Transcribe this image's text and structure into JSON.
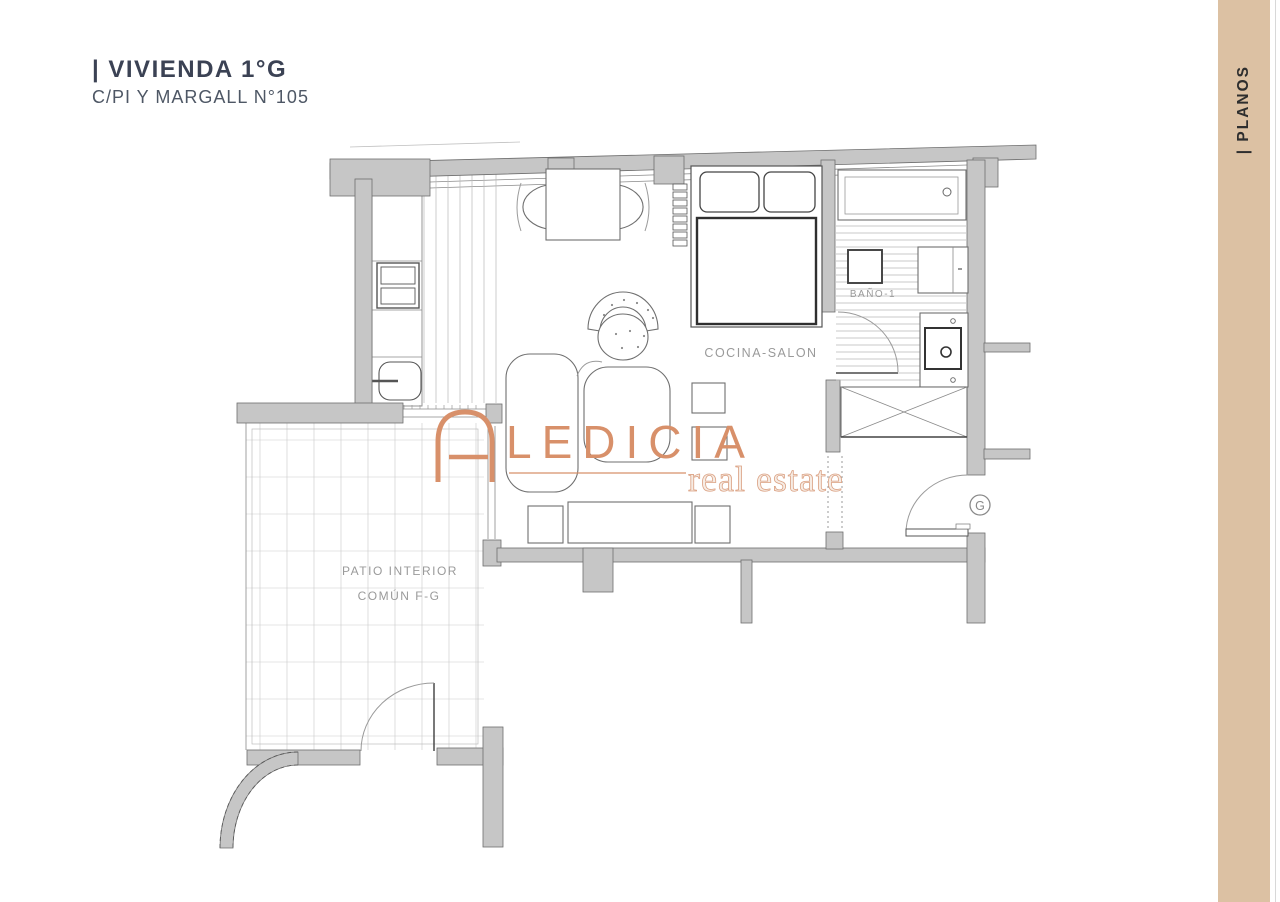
{
  "header": {
    "title": "| VIVIENDA 1°G",
    "subtitle": "C/PI Y MARGALL N°105"
  },
  "sidebar": {
    "label": "| PLANOS"
  },
  "watermark": {
    "brand": "LEDICIA",
    "tagline": "real estate"
  },
  "plan": {
    "rooms": {
      "living": "COCINA-SALON",
      "bathroom": "BAÑO-1",
      "patio_line1": "PATIO INTERIOR",
      "patio_line2": "COMÚN F-G"
    },
    "entrance_label": "G"
  },
  "colors": {
    "sidebar_bg": "#dcc1a3",
    "accent": "#d8906a",
    "title_color": "#3b4254",
    "subtitle_color": "#4e5765",
    "label": "#9a9a9a",
    "wall_fill": "#c6c6c6"
  }
}
